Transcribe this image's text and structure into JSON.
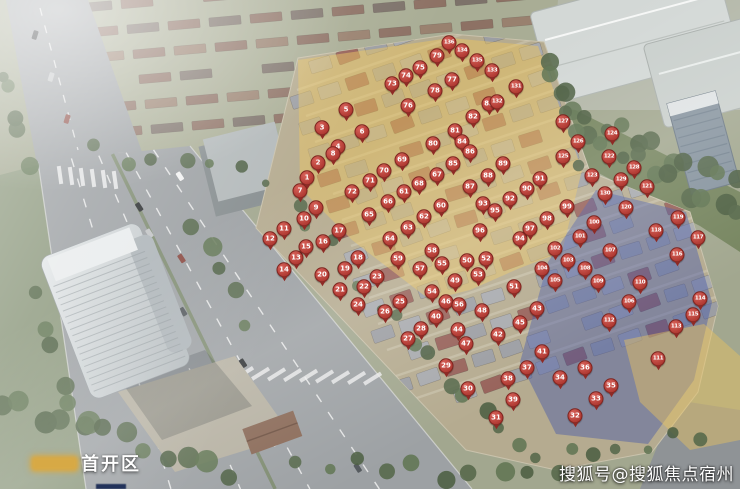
{
  "scene": {
    "description": "aerial-rendering-of-residential-development-site-plan",
    "colors": {
      "marker_red": "#b03a33",
      "first_phase_zone_yellow": "#e9c45f",
      "east_zone_blue": "#4659a8",
      "road_grey": "#9da1a4",
      "greenery": "#617553"
    }
  },
  "legend": {
    "first_phase_label": "首开区",
    "first_phase_color": "#dba83e",
    "second_swatch_color": "#22325a"
  },
  "watermark": {
    "text": "搜狐号@搜狐焦点宿州站"
  },
  "markers": [
    [
      1,
      307,
      179
    ],
    [
      2,
      318,
      164
    ],
    [
      3,
      322,
      129
    ],
    [
      4,
      338,
      148
    ],
    [
      5,
      346,
      111
    ],
    [
      6,
      362,
      133
    ],
    [
      7,
      300,
      192
    ],
    [
      8,
      333,
      155
    ],
    [
      9,
      316,
      209
    ],
    [
      10,
      304,
      220
    ],
    [
      11,
      284,
      230
    ],
    [
      12,
      270,
      240
    ],
    [
      13,
      296,
      259
    ],
    [
      14,
      284,
      271
    ],
    [
      15,
      306,
      248
    ],
    [
      16,
      323,
      243
    ],
    [
      17,
      339,
      232
    ],
    [
      18,
      358,
      259
    ],
    [
      19,
      345,
      270
    ],
    [
      20,
      322,
      276
    ],
    [
      21,
      340,
      291
    ],
    [
      22,
      364,
      288
    ],
    [
      23,
      377,
      278
    ],
    [
      24,
      358,
      306
    ],
    [
      25,
      400,
      303
    ],
    [
      26,
      385,
      313
    ],
    [
      27,
      408,
      340
    ],
    [
      28,
      421,
      330
    ],
    [
      29,
      446,
      367
    ],
    [
      30,
      468,
      390
    ],
    [
      31,
      496,
      419
    ],
    [
      32,
      575,
      417
    ],
    [
      33,
      596,
      400
    ],
    [
      34,
      560,
      379
    ],
    [
      35,
      611,
      387
    ],
    [
      36,
      585,
      369
    ],
    [
      37,
      527,
      369
    ],
    [
      38,
      508,
      380
    ],
    [
      39,
      513,
      401
    ],
    [
      40,
      436,
      318
    ],
    [
      41,
      542,
      353
    ],
    [
      42,
      498,
      336
    ],
    [
      43,
      537,
      310
    ],
    [
      44,
      458,
      331
    ],
    [
      45,
      520,
      324
    ],
    [
      46,
      446,
      303
    ],
    [
      47,
      466,
      345
    ],
    [
      48,
      482,
      312
    ],
    [
      49,
      455,
      282
    ],
    [
      50,
      467,
      262
    ],
    [
      51,
      514,
      288
    ],
    [
      52,
      486,
      260
    ],
    [
      53,
      478,
      276
    ],
    [
      54,
      432,
      293
    ],
    [
      55,
      442,
      265
    ],
    [
      56,
      459,
      306
    ],
    [
      57,
      420,
      270
    ],
    [
      58,
      432,
      252
    ],
    [
      59,
      398,
      260
    ],
    [
      60,
      441,
      207
    ],
    [
      61,
      404,
      193
    ],
    [
      62,
      424,
      218
    ],
    [
      63,
      408,
      229
    ],
    [
      64,
      390,
      240
    ],
    [
      65,
      369,
      216
    ],
    [
      66,
      388,
      203
    ],
    [
      67,
      437,
      176
    ],
    [
      68,
      419,
      185
    ],
    [
      69,
      402,
      161
    ],
    [
      70,
      384,
      172
    ],
    [
      71,
      370,
      182
    ],
    [
      72,
      352,
      193
    ],
    [
      73,
      392,
      85
    ],
    [
      74,
      406,
      77
    ],
    [
      75,
      420,
      69
    ],
    [
      76,
      408,
      107
    ],
    [
      77,
      452,
      81
    ],
    [
      78,
      435,
      92
    ],
    [
      79,
      437,
      57
    ],
    [
      80,
      433,
      145
    ],
    [
      81,
      455,
      132
    ],
    [
      82,
      473,
      118
    ],
    [
      83,
      489,
      105
    ],
    [
      84,
      462,
      143
    ],
    [
      85,
      453,
      165
    ],
    [
      86,
      470,
      153
    ],
    [
      87,
      470,
      188
    ],
    [
      88,
      488,
      177
    ],
    [
      89,
      503,
      165
    ],
    [
      90,
      527,
      190
    ],
    [
      91,
      540,
      180
    ],
    [
      92,
      510,
      200
    ],
    [
      93,
      483,
      205
    ],
    [
      94,
      520,
      240
    ],
    [
      95,
      495,
      212
    ],
    [
      96,
      480,
      232
    ],
    [
      97,
      530,
      230
    ],
    [
      98,
      547,
      220
    ],
    [
      99,
      567,
      208
    ],
    [
      100,
      594,
      224
    ],
    [
      101,
      580,
      238
    ],
    [
      102,
      555,
      250
    ],
    [
      103,
      568,
      262
    ],
    [
      104,
      542,
      270
    ],
    [
      105,
      555,
      282
    ],
    [
      106,
      629,
      303
    ],
    [
      107,
      610,
      252
    ],
    [
      108,
      585,
      270
    ],
    [
      109,
      598,
      283
    ],
    [
      110,
      640,
      284
    ],
    [
      111,
      658,
      360
    ],
    [
      112,
      609,
      322
    ],
    [
      113,
      676,
      328
    ],
    [
      114,
      700,
      300
    ],
    [
      115,
      693,
      316
    ],
    [
      116,
      677,
      256
    ],
    [
      117,
      698,
      239
    ],
    [
      118,
      656,
      232
    ],
    [
      119,
      678,
      219
    ],
    [
      120,
      626,
      209
    ],
    [
      121,
      647,
      188
    ],
    [
      122,
      609,
      158
    ],
    [
      123,
      592,
      177
    ],
    [
      124,
      612,
      135
    ],
    [
      125,
      563,
      158
    ],
    [
      126,
      578,
      143
    ],
    [
      127,
      563,
      123
    ],
    [
      128,
      634,
      169
    ],
    [
      129,
      621,
      181
    ],
    [
      130,
      605,
      195
    ],
    [
      131,
      516,
      88
    ],
    [
      132,
      497,
      103
    ],
    [
      133,
      492,
      72
    ],
    [
      134,
      462,
      52
    ],
    [
      135,
      477,
      62
    ],
    [
      136,
      449,
      44
    ]
  ]
}
